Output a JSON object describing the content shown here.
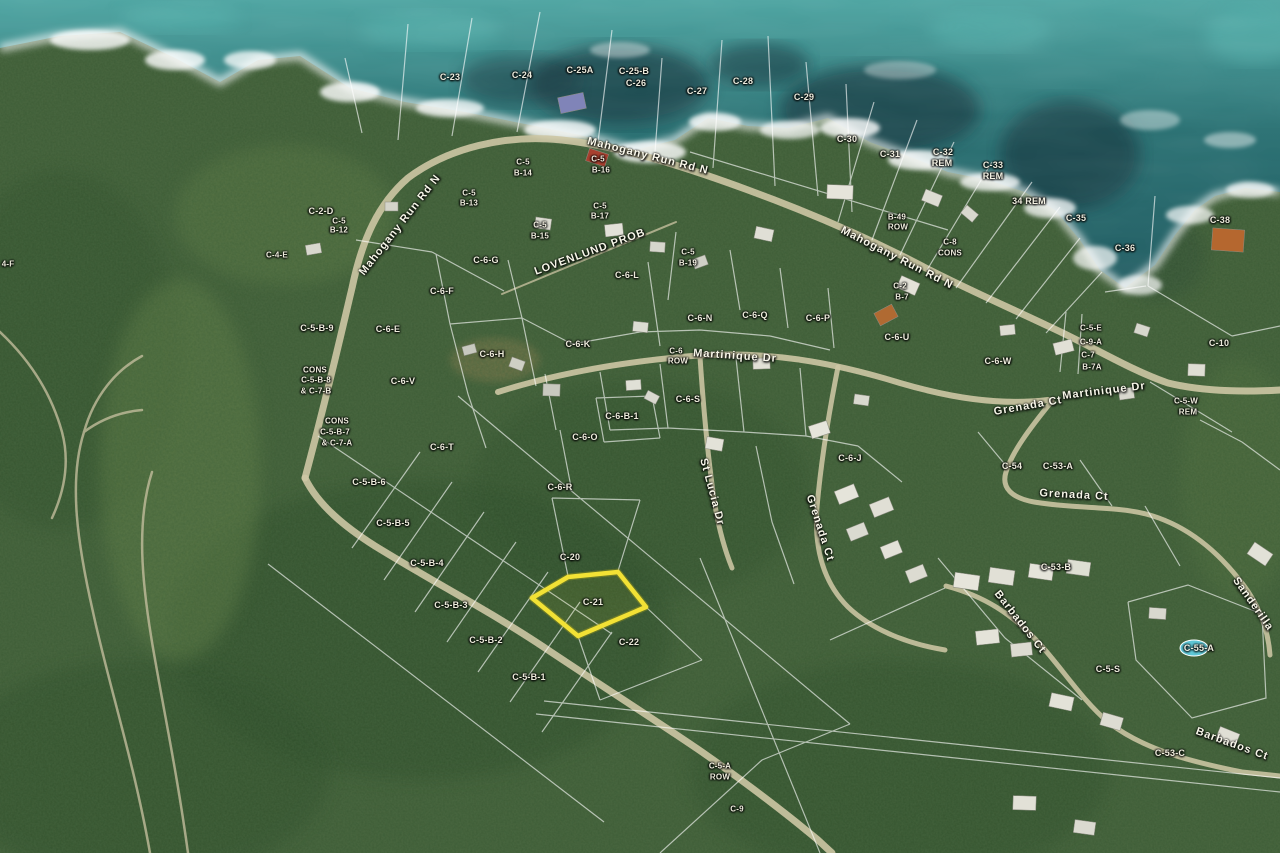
{
  "map": {
    "description": "Aerial parcel map with highlighted lot",
    "ocean_color": "#2a7173",
    "forest_color": "#3f5c36",
    "boundary_color": "#ffffff",
    "road_color": "#cdc6a4",
    "highlight": {
      "label": "C-21",
      "color": "#f2e135",
      "points": "532,598 568,577 618,572 646,607 578,636"
    },
    "parcel_labels": [
      {
        "t": "C-23",
        "x": 450,
        "y": 77
      },
      {
        "t": "C-24",
        "x": 522,
        "y": 75
      },
      {
        "t": "C-25A",
        "x": 580,
        "y": 70
      },
      {
        "t": "C-25-B",
        "x": 634,
        "y": 71
      },
      {
        "t": "C-26",
        "x": 636,
        "y": 83
      },
      {
        "t": "C-27",
        "x": 697,
        "y": 91
      },
      {
        "t": "C-28",
        "x": 743,
        "y": 81
      },
      {
        "t": "C-29",
        "x": 804,
        "y": 97
      },
      {
        "t": "C-30",
        "x": 847,
        "y": 139
      },
      {
        "t": "C-31",
        "x": 890,
        "y": 154
      },
      {
        "t": "C-32",
        "x": 943,
        "y": 152
      },
      {
        "t": "REM",
        "x": 942,
        "y": 163
      },
      {
        "t": "C-33",
        "x": 993,
        "y": 165
      },
      {
        "t": "REM",
        "x": 993,
        "y": 176
      },
      {
        "t": "34 REM",
        "x": 1029,
        "y": 201
      },
      {
        "t": "C-35",
        "x": 1076,
        "y": 218
      },
      {
        "t": "C-36",
        "x": 1125,
        "y": 248
      },
      {
        "t": "C-38",
        "x": 1220,
        "y": 220
      },
      {
        "t": "C-2-D",
        "x": 321,
        "y": 211
      },
      {
        "t": "C-5",
        "x": 339,
        "y": 221,
        "s": 8
      },
      {
        "t": "B-12",
        "x": 339,
        "y": 230,
        "s": 8
      },
      {
        "t": "C-4-E",
        "x": 277,
        "y": 255,
        "s": 8
      },
      {
        "t": "C-5",
        "x": 469,
        "y": 193,
        "s": 8
      },
      {
        "t": "B-13",
        "x": 469,
        "y": 203,
        "s": 8
      },
      {
        "t": "C-5",
        "x": 523,
        "y": 162,
        "s": 8
      },
      {
        "t": "B-14",
        "x": 523,
        "y": 173,
        "s": 8
      },
      {
        "t": "C-5",
        "x": 598,
        "y": 159,
        "s": 8
      },
      {
        "t": "B-16",
        "x": 601,
        "y": 170,
        "s": 8
      },
      {
        "t": "C-5",
        "x": 540,
        "y": 225,
        "s": 8
      },
      {
        "t": "B-15",
        "x": 540,
        "y": 236,
        "s": 8
      },
      {
        "t": "C-5",
        "x": 600,
        "y": 206,
        "s": 8
      },
      {
        "t": "B-17",
        "x": 600,
        "y": 216,
        "s": 8
      },
      {
        "t": "C-5",
        "x": 688,
        "y": 252,
        "s": 8
      },
      {
        "t": "B-19",
        "x": 688,
        "y": 263,
        "s": 8
      },
      {
        "t": "B-49",
        "x": 897,
        "y": 217,
        "s": 8
      },
      {
        "t": "ROW",
        "x": 898,
        "y": 227,
        "s": 8
      },
      {
        "t": "C-8",
        "x": 950,
        "y": 242,
        "s": 8
      },
      {
        "t": "CONS",
        "x": 950,
        "y": 253,
        "s": 8
      },
      {
        "t": "C-2",
        "x": 900,
        "y": 286,
        "s": 8
      },
      {
        "t": "B-7",
        "x": 902,
        "y": 297,
        "s": 8
      },
      {
        "t": "C-6-G",
        "x": 486,
        "y": 260
      },
      {
        "t": "C-6-F",
        "x": 442,
        "y": 291
      },
      {
        "t": "C-6-E",
        "x": 388,
        "y": 329
      },
      {
        "t": "C-6-L",
        "x": 627,
        "y": 275
      },
      {
        "t": "C-6-H",
        "x": 492,
        "y": 354
      },
      {
        "t": "C-6-N",
        "x": 700,
        "y": 318
      },
      {
        "t": "C-6-Q",
        "x": 755,
        "y": 315
      },
      {
        "t": "C-6-P",
        "x": 818,
        "y": 318
      },
      {
        "t": "C-6-U",
        "x": 897,
        "y": 337
      },
      {
        "t": "C-6-K",
        "x": 578,
        "y": 344
      },
      {
        "t": "C-6-S",
        "x": 688,
        "y": 399
      },
      {
        "t": "C-6-O",
        "x": 585,
        "y": 437
      },
      {
        "t": "C-6-B-1",
        "x": 622,
        "y": 416
      },
      {
        "t": "C-6",
        "x": 676,
        "y": 351,
        "s": 8
      },
      {
        "t": "ROW",
        "x": 678,
        "y": 361,
        "s": 8
      },
      {
        "t": "C-6-R",
        "x": 560,
        "y": 487
      },
      {
        "t": "C-6-T",
        "x": 442,
        "y": 447
      },
      {
        "t": "C-6-V",
        "x": 403,
        "y": 381
      },
      {
        "t": "C-6-J",
        "x": 850,
        "y": 458
      },
      {
        "t": "C-6-W",
        "x": 998,
        "y": 361
      },
      {
        "t": "C-5-B-9",
        "x": 317,
        "y": 328
      },
      {
        "t": "CONS",
        "x": 315,
        "y": 370,
        "s": 8
      },
      {
        "t": "C-5-B-8",
        "x": 316,
        "y": 380,
        "s": 8
      },
      {
        "t": "& C-7-B",
        "x": 316,
        "y": 391,
        "s": 8
      },
      {
        "t": "CONS",
        "x": 337,
        "y": 421,
        "s": 8
      },
      {
        "t": "C-5-B-7",
        "x": 335,
        "y": 432,
        "s": 8
      },
      {
        "t": "& C-7-A",
        "x": 337,
        "y": 443,
        "s": 8
      },
      {
        "t": "C-5-B-6",
        "x": 369,
        "y": 482
      },
      {
        "t": "C-5-B-5",
        "x": 393,
        "y": 523
      },
      {
        "t": "C-5-B-4",
        "x": 427,
        "y": 563
      },
      {
        "t": "C-5-B-3",
        "x": 451,
        "y": 605
      },
      {
        "t": "C-5-B-2",
        "x": 486,
        "y": 640
      },
      {
        "t": "C-5-B-1",
        "x": 529,
        "y": 677
      },
      {
        "t": "C-20",
        "x": 570,
        "y": 557
      },
      {
        "t": "C-21",
        "x": 593,
        "y": 602
      },
      {
        "t": "C-22",
        "x": 629,
        "y": 642
      },
      {
        "t": "C-5-E",
        "x": 1091,
        "y": 328,
        "s": 8
      },
      {
        "t": "C-9-A",
        "x": 1091,
        "y": 342,
        "s": 8
      },
      {
        "t": "C-7",
        "x": 1088,
        "y": 355,
        "s": 8
      },
      {
        "t": "B-7A",
        "x": 1092,
        "y": 367,
        "s": 8
      },
      {
        "t": "C-10",
        "x": 1219,
        "y": 343
      },
      {
        "t": "C-5-W",
        "x": 1186,
        "y": 401,
        "s": 8
      },
      {
        "t": "REM",
        "x": 1188,
        "y": 412,
        "s": 8
      },
      {
        "t": "C-54",
        "x": 1012,
        "y": 466
      },
      {
        "t": "C-53-A",
        "x": 1058,
        "y": 466
      },
      {
        "t": "C-53-B",
        "x": 1056,
        "y": 567
      },
      {
        "t": "C-55-A",
        "x": 1199,
        "y": 648
      },
      {
        "t": "C-5-S",
        "x": 1108,
        "y": 669
      },
      {
        "t": "C-53-C",
        "x": 1170,
        "y": 753
      },
      {
        "t": "C-5-A",
        "x": 720,
        "y": 766,
        "s": 8
      },
      {
        "t": "ROW",
        "x": 720,
        "y": 777,
        "s": 8
      },
      {
        "t": "C-9",
        "x": 737,
        "y": 809,
        "s": 8
      },
      {
        "t": "4-F",
        "x": 8,
        "y": 264,
        "s": 8
      }
    ],
    "road_labels": [
      {
        "t": "Mahogany Run Rd N",
        "x": 400,
        "y": 225,
        "r": -52
      },
      {
        "t": "Mahogany Run Rd N",
        "x": 648,
        "y": 156,
        "r": 14
      },
      {
        "t": "Mahogany Run Rd N",
        "x": 897,
        "y": 258,
        "r": 27
      },
      {
        "t": "LOVENLUND PROB",
        "x": 590,
        "y": 252,
        "r": -20
      },
      {
        "t": "Martinique Dr",
        "x": 735,
        "y": 356,
        "r": 4
      },
      {
        "t": "Martinique Dr",
        "x": 1104,
        "y": 391,
        "r": -7
      },
      {
        "t": "Grenada Ct",
        "x": 1028,
        "y": 406,
        "r": -10
      },
      {
        "t": "Grenada Ct",
        "x": 1074,
        "y": 495,
        "r": 3
      },
      {
        "t": "Grenada Ct",
        "x": 820,
        "y": 528,
        "r": 72
      },
      {
        "t": "St Lucia Dr",
        "x": 712,
        "y": 492,
        "r": 75
      },
      {
        "t": "Barbados Ct",
        "x": 1020,
        "y": 622,
        "r": 52
      },
      {
        "t": "Barbados Ct",
        "x": 1232,
        "y": 744,
        "r": 20
      },
      {
        "t": "Sanderilla",
        "x": 1253,
        "y": 604,
        "r": 55
      }
    ]
  }
}
